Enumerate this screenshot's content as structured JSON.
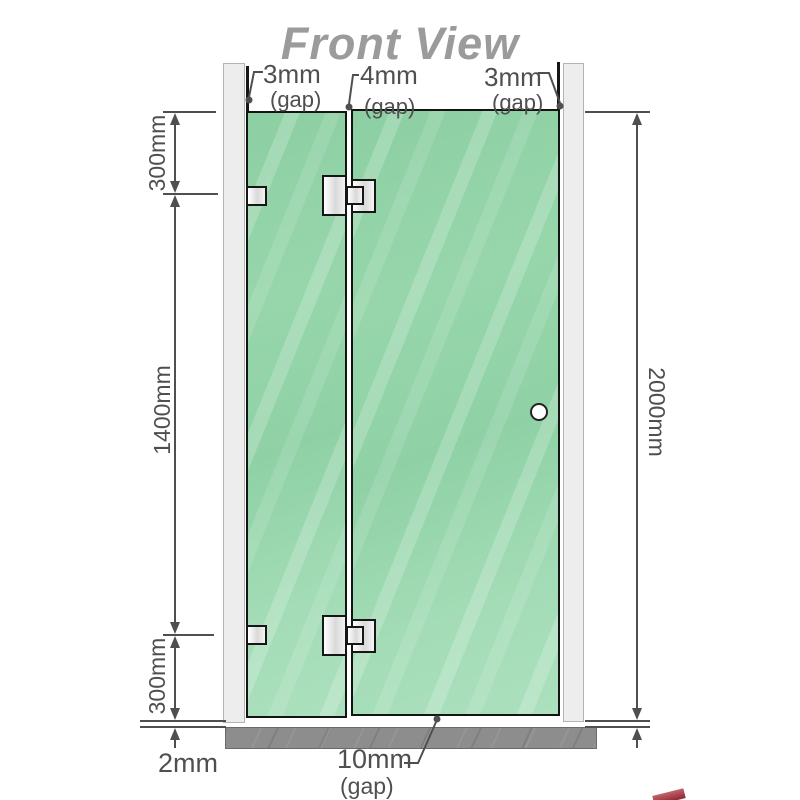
{
  "title": "Front View",
  "colors": {
    "glass_green": "#93d3a8",
    "wall_gray": "#ededed",
    "floor_gray": "#8d8d8d",
    "line_dark": "#4f4f4f",
    "title_gray": "#9b9b9b",
    "hinge_white": "#f3f3f3",
    "watermark_red": "#8f2832"
  },
  "gap_labels": {
    "top_left": {
      "value": "3mm",
      "note": "(gap)"
    },
    "top_center": {
      "value": "4mm",
      "note": "(gap)"
    },
    "top_right": {
      "value": "3mm",
      "note": "(gap)"
    },
    "bottom_center": {
      "value": "10mm",
      "note": "(gap)"
    },
    "bottom_left_gap": {
      "value": "2mm"
    }
  },
  "height_labels": {
    "left_top": "300mm",
    "left_middle": "1400mm",
    "left_bottom": "300mm",
    "right_total": "2000mm"
  }
}
